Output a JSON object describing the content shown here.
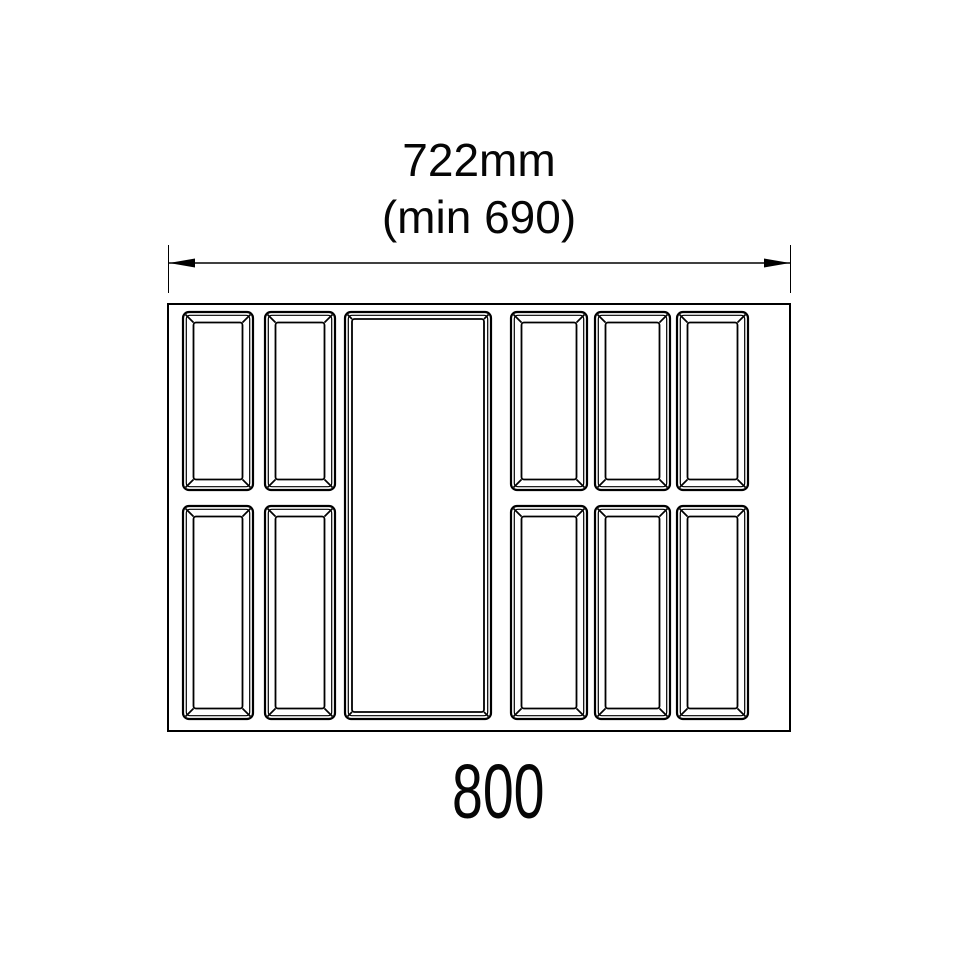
{
  "page": {
    "background": "#ffffff",
    "line_color": "#000000",
    "text_color": "#060606"
  },
  "dimension_label": {
    "primary": "722mm",
    "secondary": "(min 690)"
  },
  "bottom_label": {
    "value": "800"
  },
  "diagram": {
    "dimension_arrow": {
      "y": 263,
      "x1": 169,
      "x2": 790,
      "ext_x1": 168.5,
      "ext_x2": 790.5,
      "ext_top": 245,
      "ext_bottom": 293,
      "arrow_length": 26,
      "arrow_half_width": 4.5
    },
    "tray_outline": {
      "x": 168,
      "y": 304,
      "w": 622,
      "h": 427
    },
    "compartments": [
      {
        "id": "top-left-1",
        "x": 183,
        "y": 312,
        "w": 70,
        "h": 178,
        "bevel": 10.5
      },
      {
        "id": "top-left-2",
        "x": 265,
        "y": 312,
        "w": 70,
        "h": 178,
        "bevel": 10.5
      },
      {
        "id": "center-large",
        "x": 345,
        "y": 312,
        "w": 146,
        "h": 407,
        "bevel": 7
      },
      {
        "id": "top-right-1",
        "x": 511,
        "y": 312,
        "w": 76,
        "h": 178,
        "bevel": 10.5
      },
      {
        "id": "top-right-2",
        "x": 595,
        "y": 312,
        "w": 75,
        "h": 178,
        "bevel": 10.5
      },
      {
        "id": "top-right-3",
        "x": 677,
        "y": 312,
        "w": 71,
        "h": 178,
        "bevel": 10.5
      },
      {
        "id": "bottom-left-1",
        "x": 183,
        "y": 506,
        "w": 70,
        "h": 213,
        "bevel": 10.5
      },
      {
        "id": "bottom-left-2",
        "x": 265,
        "y": 506,
        "w": 70,
        "h": 213,
        "bevel": 10.5
      },
      {
        "id": "bottom-right-1",
        "x": 511,
        "y": 506,
        "w": 76,
        "h": 213,
        "bevel": 10.5
      },
      {
        "id": "bottom-right-2",
        "x": 595,
        "y": 506,
        "w": 75,
        "h": 213,
        "bevel": 10.5
      },
      {
        "id": "bottom-right-3",
        "x": 677,
        "y": 506,
        "w": 71,
        "h": 213,
        "bevel": 10.5
      }
    ],
    "strokes": {
      "outline": 2,
      "comp_outer": 2.2,
      "comp_rim": 1.2,
      "comp_trough": 1.8,
      "comp_diagonal": 1.7,
      "dim_line": 1.4,
      "ext_line": 1
    }
  }
}
